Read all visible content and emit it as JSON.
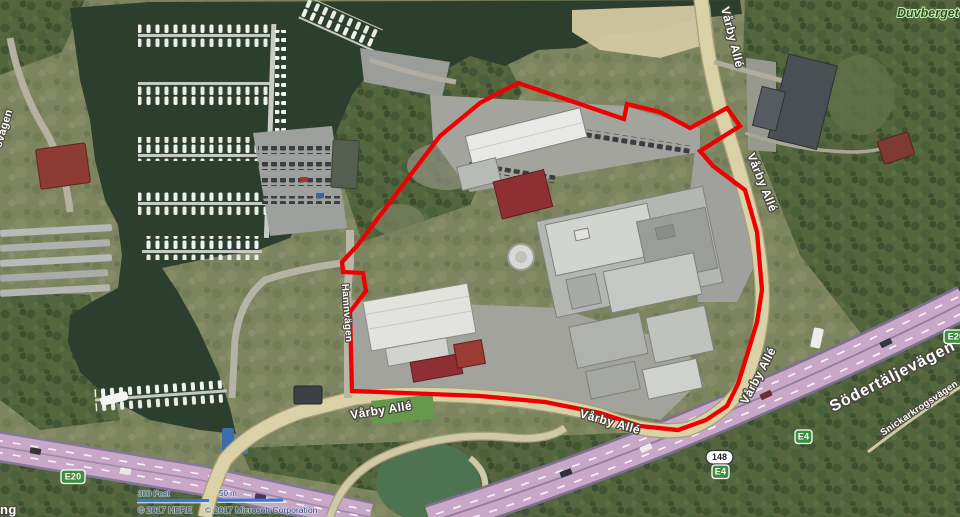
{
  "map": {
    "attribution": {
      "here": "© 2017 HERE",
      "microsoft": "© 2017 Microsoft Corporation"
    },
    "scale_bar": {
      "imperial": "300 Feet",
      "metric": "50 m"
    },
    "place_labels": {
      "duvberget": "Duvberget"
    },
    "road_labels": {
      "varby_alle": "Vårby Allé",
      "sodertaljevagen": "Södertäljevägen",
      "snickarkrogsvagen": "Snickarkrogsvägen",
      "hamnvagen": "Hamnvägen",
      "partial_left_edge": "svägen",
      "partial_bottom_corner": "ng"
    },
    "route_shields": {
      "e20": "E20",
      "e4": "E4",
      "road_148": "148"
    },
    "colors": {
      "boundary_red": "#ee0000",
      "motorway_pink": "#c9a7c9",
      "road_tan": "#d9d2a6",
      "shield_green": "#3f8e3f",
      "water_dark": "#2c3e2e",
      "scale_bar_blue": "#2f7bd6",
      "place_label_green": "#1d5a15"
    }
  }
}
